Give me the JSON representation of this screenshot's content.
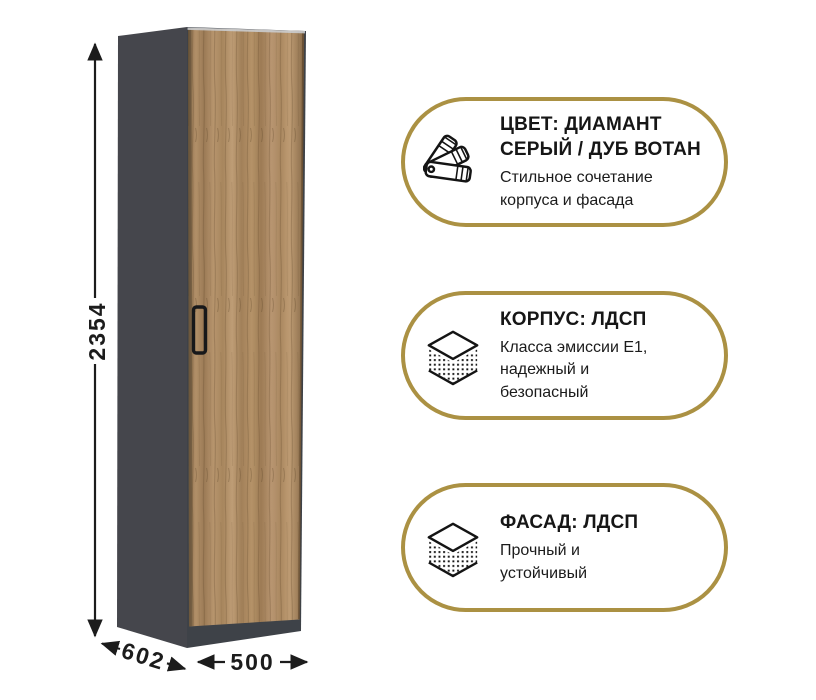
{
  "product": {
    "type": "single-door wardrobe",
    "carcass_color_hex": "#45464c",
    "plinth_color_hex": "#3e4248",
    "wood_base_hex": "#b29674",
    "handle_color_hex": "#17181a"
  },
  "dimensions": {
    "height_mm": "2354",
    "depth_mm": "602",
    "width_mm": "500"
  },
  "accent": {
    "gold_hex": "#ab9143",
    "text_hex": "#161616"
  },
  "badges": [
    {
      "icon": "color-swatch-fan",
      "title_lines": [
        "ЦВЕТ: ДИАМАНТ",
        "СЕРЫЙ / ДУБ ВОТАН"
      ],
      "desc_lines": [
        "Стильное сочетание",
        "корпуса и фасада"
      ]
    },
    {
      "icon": "laminated-board-layers",
      "title_lines": [
        "КОРПУС: ЛДСП"
      ],
      "desc_lines": [
        "Класса эмиссии Е1,",
        "надежный и",
        "безопасный"
      ]
    },
    {
      "icon": "laminated-board-layers",
      "title_lines": [
        "ФАСАД: ЛДСП"
      ],
      "desc_lines": [
        "Прочный и",
        "устойчивый"
      ]
    }
  ]
}
